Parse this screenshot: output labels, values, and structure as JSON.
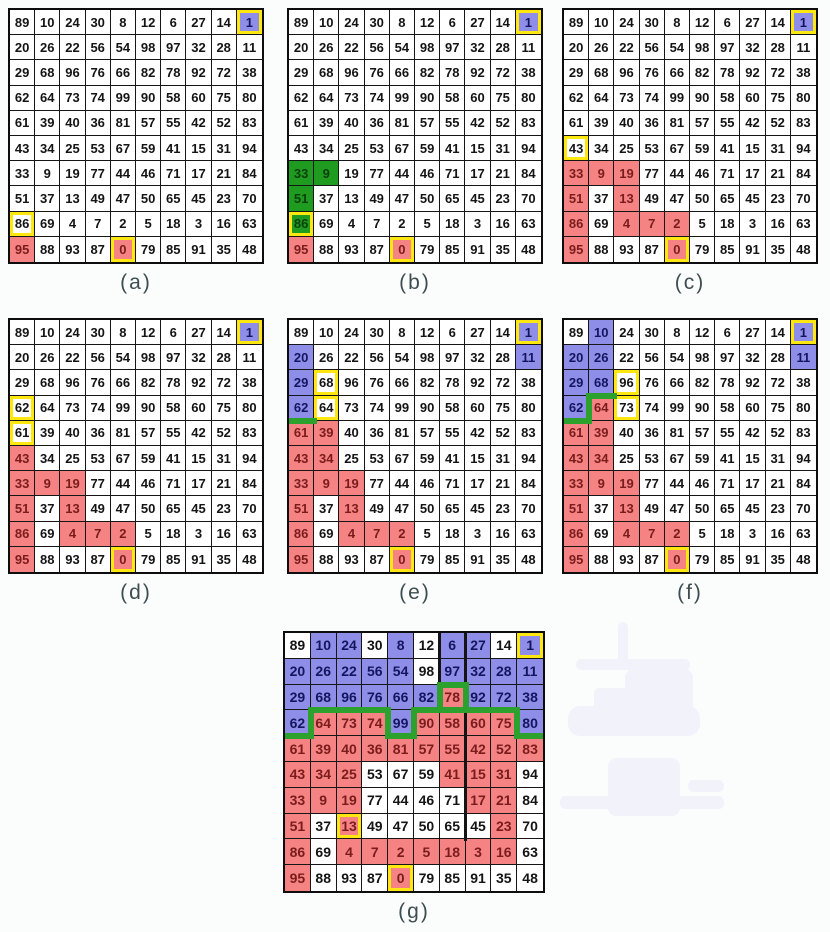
{
  "figure_label_row1": [
    "(a)",
    "(b)",
    "(c)"
  ],
  "colors": {
    "red": "#f58383",
    "blue": "#8e8ee9",
    "green_fill": "#1f9c1f",
    "green_line": "#2da12d",
    "yellow": "#ffe70f",
    "grid_line": "#161616",
    "label_text": "#3e4e50"
  },
  "grid_values": [
    [
      89,
      10,
      24,
      30,
      8,
      12,
      6,
      27,
      14,
      1
    ],
    [
      20,
      26,
      22,
      56,
      54,
      98,
      97,
      32,
      28,
      11
    ],
    [
      29,
      68,
      96,
      76,
      66,
      82,
      78,
      92,
      72,
      38
    ],
    [
      62,
      64,
      73,
      74,
      99,
      90,
      58,
      60,
      75,
      80
    ],
    [
      61,
      39,
      40,
      36,
      81,
      57,
      55,
      42,
      52,
      83
    ],
    [
      43,
      34,
      25,
      53,
      67,
      59,
      41,
      15,
      31,
      94
    ],
    [
      33,
      9,
      19,
      77,
      44,
      46,
      71,
      17,
      21,
      84
    ],
    [
      51,
      37,
      13,
      49,
      47,
      50,
      65,
      45,
      23,
      70
    ],
    [
      86,
      69,
      4,
      7,
      2,
      5,
      18,
      3,
      16,
      63
    ],
    [
      95,
      88,
      93,
      87,
      0,
      79,
      85,
      91,
      35,
      48
    ]
  ],
  "panels": [
    {
      "label": "(a)",
      "blue": [
        [
          0,
          9
        ]
      ],
      "green": [],
      "red": [
        [
          9,
          0
        ],
        [
          9,
          4
        ]
      ],
      "yellow": [
        [
          0,
          9
        ],
        [
          8,
          0
        ],
        [
          9,
          4
        ]
      ],
      "green_edges": [],
      "black_edges": []
    },
    {
      "label": "(b)",
      "blue": [
        [
          0,
          9
        ]
      ],
      "green": [
        [
          6,
          0
        ],
        [
          6,
          1
        ],
        [
          7,
          0
        ],
        [
          8,
          0
        ]
      ],
      "red": [
        [
          9,
          0
        ],
        [
          9,
          4
        ]
      ],
      "yellow": [
        [
          0,
          9
        ],
        [
          8,
          0
        ],
        [
          9,
          4
        ]
      ],
      "green_edges": [],
      "black_edges": []
    },
    {
      "label": "(c)",
      "blue": [
        [
          0,
          9
        ]
      ],
      "green": [],
      "red": [
        [
          6,
          0
        ],
        [
          6,
          1
        ],
        [
          6,
          2
        ],
        [
          7,
          0
        ],
        [
          7,
          2
        ],
        [
          8,
          0
        ],
        [
          8,
          2
        ],
        [
          8,
          3
        ],
        [
          8,
          4
        ],
        [
          9,
          0
        ],
        [
          9,
          4
        ]
      ],
      "yellow": [
        [
          0,
          9
        ],
        [
          5,
          0
        ],
        [
          9,
          4
        ]
      ],
      "green_edges": [],
      "black_edges": []
    },
    {
      "label": "(d)",
      "blue": [
        [
          0,
          9
        ]
      ],
      "green": [],
      "red": [
        [
          5,
          0
        ],
        [
          6,
          0
        ],
        [
          6,
          1
        ],
        [
          6,
          2
        ],
        [
          7,
          0
        ],
        [
          7,
          2
        ],
        [
          8,
          0
        ],
        [
          8,
          2
        ],
        [
          8,
          3
        ],
        [
          8,
          4
        ],
        [
          9,
          0
        ],
        [
          9,
          4
        ]
      ],
      "yellow": [
        [
          0,
          9
        ],
        [
          3,
          0
        ],
        [
          4,
          0
        ],
        [
          9,
          4
        ]
      ],
      "green_edges": [],
      "black_edges": []
    },
    {
      "label": "(e)",
      "blue": [
        [
          0,
          9
        ],
        [
          1,
          0
        ],
        [
          1,
          9
        ],
        [
          2,
          0
        ],
        [
          3,
          0
        ]
      ],
      "green": [],
      "red": [
        [
          4,
          0
        ],
        [
          4,
          1
        ],
        [
          5,
          0
        ],
        [
          5,
          1
        ],
        [
          6,
          0
        ],
        [
          6,
          1
        ],
        [
          6,
          2
        ],
        [
          7,
          0
        ],
        [
          7,
          2
        ],
        [
          8,
          0
        ],
        [
          8,
          2
        ],
        [
          8,
          3
        ],
        [
          8,
          4
        ],
        [
          9,
          0
        ],
        [
          9,
          4
        ]
      ],
      "yellow": [
        [
          0,
          9
        ],
        [
          2,
          1
        ],
        [
          3,
          1
        ],
        [
          9,
          4
        ]
      ],
      "green_edges": [
        {
          "r": 3,
          "c": 0,
          "s": "b"
        }
      ],
      "black_edges": []
    },
    {
      "label": "(f)",
      "blue": [
        [
          0,
          1
        ],
        [
          0,
          9
        ],
        [
          1,
          0
        ],
        [
          1,
          1
        ],
        [
          1,
          9
        ],
        [
          2,
          0
        ],
        [
          2,
          1
        ],
        [
          3,
          0
        ]
      ],
      "green": [],
      "red": [
        [
          3,
          1
        ],
        [
          4,
          0
        ],
        [
          4,
          1
        ],
        [
          5,
          0
        ],
        [
          5,
          1
        ],
        [
          6,
          0
        ],
        [
          6,
          1
        ],
        [
          6,
          2
        ],
        [
          7,
          0
        ],
        [
          7,
          2
        ],
        [
          8,
          0
        ],
        [
          8,
          2
        ],
        [
          8,
          3
        ],
        [
          8,
          4
        ],
        [
          9,
          0
        ],
        [
          9,
          4
        ]
      ],
      "yellow": [
        [
          0,
          9
        ],
        [
          2,
          2
        ],
        [
          3,
          2
        ],
        [
          9,
          4
        ]
      ],
      "green_edges": [
        {
          "r": 3,
          "c": 0,
          "s": "b"
        },
        {
          "r": 3,
          "c": 1,
          "s": "l"
        },
        {
          "r": 3,
          "c": 1,
          "s": "t"
        }
      ],
      "black_edges": []
    },
    {
      "label": "(g)",
      "blue": [
        [
          0,
          1
        ],
        [
          0,
          2
        ],
        [
          0,
          4
        ],
        [
          0,
          6
        ],
        [
          0,
          7
        ],
        [
          0,
          9
        ],
        [
          1,
          0
        ],
        [
          1,
          1
        ],
        [
          1,
          2
        ],
        [
          1,
          3
        ],
        [
          1,
          4
        ],
        [
          1,
          6
        ],
        [
          1,
          7
        ],
        [
          1,
          8
        ],
        [
          1,
          9
        ],
        [
          2,
          0
        ],
        [
          2,
          1
        ],
        [
          2,
          2
        ],
        [
          2,
          3
        ],
        [
          2,
          4
        ],
        [
          2,
          5
        ],
        [
          2,
          7
        ],
        [
          2,
          8
        ],
        [
          2,
          9
        ],
        [
          3,
          0
        ],
        [
          3,
          4
        ],
        [
          3,
          9
        ]
      ],
      "green": [],
      "red": [
        [
          2,
          6
        ],
        [
          3,
          1
        ],
        [
          3,
          2
        ],
        [
          3,
          3
        ],
        [
          3,
          5
        ],
        [
          3,
          6
        ],
        [
          3,
          7
        ],
        [
          3,
          8
        ],
        [
          4,
          0
        ],
        [
          4,
          1
        ],
        [
          4,
          2
        ],
        [
          4,
          3
        ],
        [
          4,
          4
        ],
        [
          4,
          5
        ],
        [
          4,
          6
        ],
        [
          4,
          7
        ],
        [
          4,
          8
        ],
        [
          4,
          9
        ],
        [
          5,
          0
        ],
        [
          5,
          1
        ],
        [
          5,
          2
        ],
        [
          5,
          6
        ],
        [
          5,
          7
        ],
        [
          5,
          8
        ],
        [
          6,
          0
        ],
        [
          6,
          1
        ],
        [
          6,
          2
        ],
        [
          6,
          7
        ],
        [
          6,
          8
        ],
        [
          7,
          0
        ],
        [
          7,
          2
        ],
        [
          7,
          8
        ],
        [
          8,
          0
        ],
        [
          8,
          2
        ],
        [
          8,
          3
        ],
        [
          8,
          4
        ],
        [
          8,
          5
        ],
        [
          8,
          6
        ],
        [
          8,
          7
        ],
        [
          8,
          8
        ],
        [
          9,
          0
        ],
        [
          9,
          4
        ]
      ],
      "yellow": [
        [
          0,
          9
        ],
        [
          7,
          2
        ],
        [
          9,
          4
        ]
      ],
      "green_edges": [
        {
          "r": 3,
          "c": 0,
          "s": "b"
        },
        {
          "r": 3,
          "c": 1,
          "s": "l"
        },
        {
          "r": 3,
          "c": 1,
          "s": "t"
        },
        {
          "r": 3,
          "c": 2,
          "s": "t"
        },
        {
          "r": 3,
          "c": 3,
          "s": "t"
        },
        {
          "r": 3,
          "c": 4,
          "s": "l"
        },
        {
          "r": 3,
          "c": 4,
          "s": "b"
        },
        {
          "r": 3,
          "c": 4,
          "s": "r"
        },
        {
          "r": 3,
          "c": 5,
          "s": "t"
        },
        {
          "r": 3,
          "c": 6,
          "s": "t"
        },
        {
          "r": 2,
          "c": 6,
          "s": "l"
        },
        {
          "r": 2,
          "c": 6,
          "s": "t"
        },
        {
          "r": 2,
          "c": 6,
          "s": "r"
        },
        {
          "r": 3,
          "c": 7,
          "s": "t"
        },
        {
          "r": 3,
          "c": 8,
          "s": "t"
        },
        {
          "r": 3,
          "c": 9,
          "s": "l"
        },
        {
          "r": 3,
          "c": 9,
          "s": "b"
        }
      ],
      "black_edges": [
        {
          "r": 0,
          "c": 5,
          "s": "r"
        },
        {
          "r": 1,
          "c": 5,
          "s": "r"
        },
        {
          "r": 0,
          "c": 6,
          "s": "r"
        },
        {
          "r": 1,
          "c": 6,
          "s": "r"
        },
        {
          "r": 3,
          "c": 6,
          "s": "r"
        },
        {
          "r": 4,
          "c": 6,
          "s": "r"
        },
        {
          "r": 5,
          "c": 6,
          "s": "r"
        },
        {
          "r": 6,
          "c": 6,
          "s": "r"
        },
        {
          "r": 7,
          "c": 6,
          "s": "r"
        }
      ]
    }
  ]
}
